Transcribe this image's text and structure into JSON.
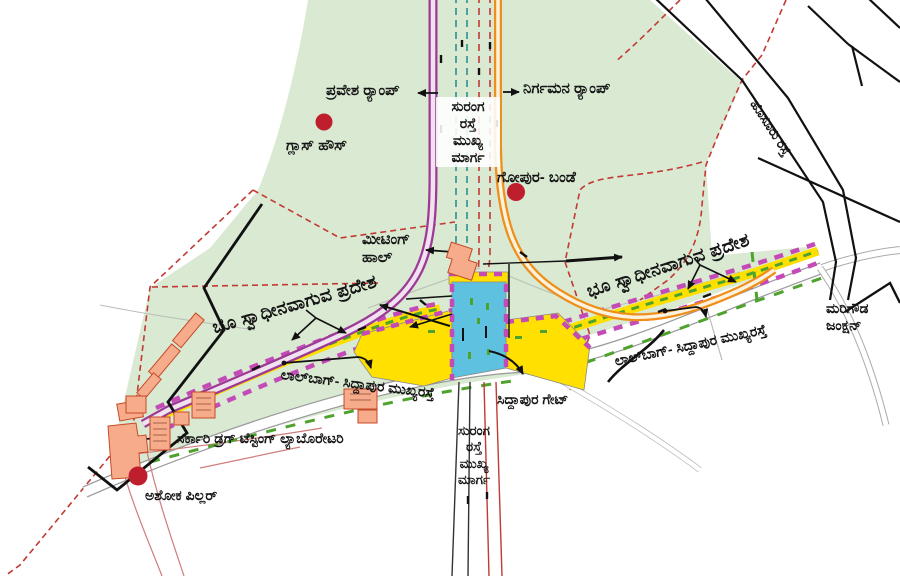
{
  "map": {
    "title_hint": "Tunnel road alignment plan at Lalbagh (Kannada annotated map)",
    "labels": {
      "entrance_ramp": {
        "text": "ಪ್ರವೇಶ ರ‍್ಯಾಂಪ್"
      },
      "exit_ramp": {
        "text": "ನಿರ್ಗಮನ ರ‍್ಯಾಂಪ್"
      },
      "tunnel_main_top": {
        "text": "ಸುರಂಗ\nರಸ್ತೆ\nಮುಖ್ಯ\nಮಾರ್ಗ"
      },
      "glass_house": {
        "text": "ಗ್ಲಾಸ್ ಹೌಸ್"
      },
      "gopura_bande": {
        "text": "ಗೋಪುರ- ಬಂಡೆ"
      },
      "hosur_road": {
        "text": "ಹೊಸೂರು ರಸ್ತೆ"
      },
      "meeting_hall": {
        "text": "ಮೀಟಿಂಗ್\nಹಾಲ್"
      },
      "land_acq_left": {
        "text": "ಭೂ ಸ್ವಾಧೀನವಾಗುವ ಪ್ರದೇಶ"
      },
      "land_acq_right": {
        "text": "ಭೂ ಸ್ವಾಧೀನವಾಗುವ ಪ್ರದೇಶ"
      },
      "lalbagh_road_left": {
        "text": "ಲಾಲ್‌ಬಾಗ್- ಸಿದ್ದಾಪುರ ಮುಖ್ಯರಸ್ತೆ"
      },
      "lalbagh_road_right": {
        "text": "ಲಾಲ್‌ಬಾಗ್- ಸಿದ್ದಾಪುರ ಮುಖ್ಯರಸ್ತೆ"
      },
      "siddapura_gate": {
        "text": "ಸಿದ್ದಾಪುರ ಗೇಟ್"
      },
      "marigowda_junction": {
        "text": "ಮರಿಗೌಡ\nಜಂಕ್ಷನ್"
      },
      "drug_lab": {
        "text": "ಸರ್ಕಾರಿ ಡ್ರಗ್ ಟೆಸ್ಟಿಂಗ್ ಲ್ಯಾಬೊರೇಟರಿ"
      },
      "ashoka_pillar": {
        "text": "ಅಶೋಕ ಪಿಲ್ಲರ್"
      },
      "tunnel_main_bottom": {
        "text": "ಸುರಂಗ\nರಸ್ತೆ\nಮುಖ್ಯ\nಮಾರ್ಗ"
      }
    },
    "markers": {
      "glass_house_dot": "red landmark dot",
      "gopura_bande_dot": "red landmark dot",
      "ashoka_pillar_dot": "red landmark dot"
    },
    "colors": {
      "park_green": "#d9e9d2",
      "tunnel_purple": "#9c3a96",
      "ramp_orange": "#ef8f1b",
      "acquisition_yellow": "#ffdf00",
      "portal_blue": "#5ec1e0",
      "boundary_magenta": "#c44ab8",
      "marker_green": "#4ea32c",
      "red_dash_boundary": "#c23a34",
      "landmark_red": "#bf1f2d",
      "building_salmon": "#f6ab8b",
      "building_outline": "#c64a28",
      "road_black": "#111111"
    }
  }
}
